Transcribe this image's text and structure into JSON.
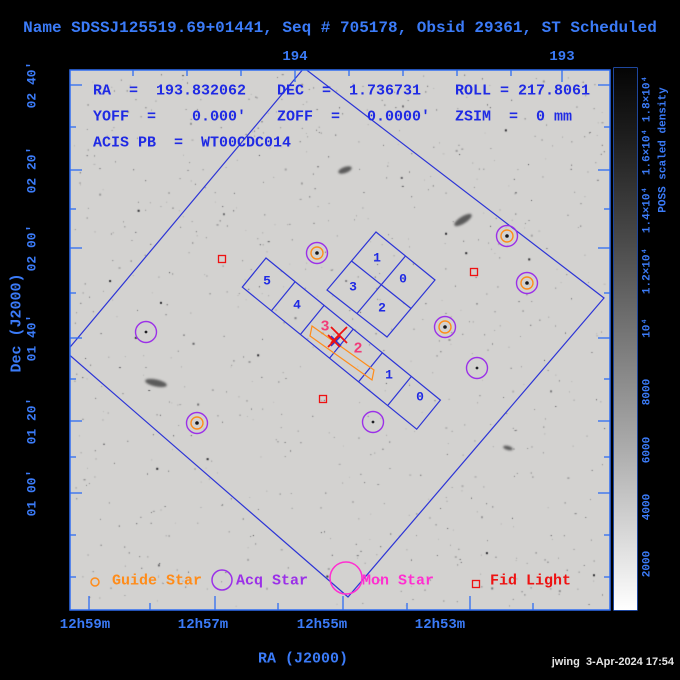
{
  "title": "Name SDSSJ125519.69+01441, Seq # 705178, Obsid 29361, ST Scheduled",
  "overlay": {
    "ra": "RA  =  193.832062",
    "dec": "DEC  =  1.736731",
    "roll": "ROLL = 217.8061",
    "yoff": "YOFF  =    0.000'",
    "zoff": "ZOFF  =   0.0000'",
    "zsim": "ZSIM  =  0 mm",
    "acis_pb": "ACIS PB  =  WT00CDC014"
  },
  "axes": {
    "x_label": "RA (J2000)",
    "y_label": "Dec (J2000)",
    "top_ticks": [
      {
        "label": "194",
        "x": 295
      },
      {
        "label": "193",
        "x": 562
      }
    ],
    "top_minor": [
      133,
      187,
      241,
      349,
      403,
      457,
      511
    ],
    "bottom_ticks": [
      {
        "label": "12h59m",
        "tick_x": 89,
        "label_x": 85
      },
      {
        "label": "12h57m",
        "tick_x": 215,
        "label_x": 203
      },
      {
        "label": "12h55m",
        "tick_x": 343,
        "label_x": 322
      },
      {
        "label": "12h53m",
        "tick_x": 470,
        "label_x": 440
      }
    ],
    "bottom_minor": [
      150,
      278,
      407,
      533
    ],
    "left_ticks": [
      {
        "label": "02 40'",
        "y": 85
      },
      {
        "label": "02 20'",
        "y": 170
      },
      {
        "label": "02 00'",
        "y": 248
      },
      {
        "label": "01 40'",
        "y": 338
      },
      {
        "label": "01 20'",
        "y": 421
      },
      {
        "label": "01 00'",
        "y": 493
      }
    ],
    "left_minor": [
      127,
      209,
      293,
      379,
      457,
      535,
      577
    ]
  },
  "colorbar": {
    "title": "POSS scaled density",
    "ticks": [
      {
        "label": "1.8×10⁴",
        "y": 99
      },
      {
        "label": "1.6×10⁴",
        "y": 152
      },
      {
        "label": "1.4×10⁴",
        "y": 210
      },
      {
        "label": "1.2×10⁴",
        "y": 271
      },
      {
        "label": "10⁴",
        "y": 328
      },
      {
        "label": "8000",
        "y": 392
      },
      {
        "label": "6000",
        "y": 450
      },
      {
        "label": "4000",
        "y": 507
      },
      {
        "label": "2000",
        "y": 564
      }
    ],
    "minor": [
      125,
      181,
      240,
      299,
      360,
      421,
      478,
      535,
      590
    ]
  },
  "fov": {
    "outline": [
      [
        304,
        68
      ],
      [
        604,
        298
      ],
      [
        348,
        597
      ],
      [
        66,
        352
      ]
    ],
    "acis_i": {
      "outline": [
        [
          376,
          232
        ],
        [
          435,
          280
        ],
        [
          387,
          337
        ],
        [
          327,
          290
        ]
      ],
      "dividers": [
        [
          [
            405.5,
            256
          ],
          [
            357,
            313.5
          ]
        ],
        [
          [
            351.5,
            261
          ],
          [
            411,
            308.5
          ]
        ]
      ]
    },
    "acis_s": {
      "outline": [
        [
          266,
          258
        ],
        [
          440.4,
          400.1
        ],
        [
          416.7,
          429.2
        ],
        [
          242.3,
          287.1
        ]
      ],
      "dividers": [
        [
          [
            295.1,
            281.7
          ],
          [
            271.4,
            310.8
          ]
        ],
        [
          [
            324.1,
            305.4
          ],
          [
            300.4,
            334.5
          ]
        ],
        [
          [
            353.2,
            329.1
          ],
          [
            329.5,
            358.2
          ]
        ],
        [
          [
            382.3,
            352.8
          ],
          [
            358.6,
            381.8
          ]
        ],
        [
          [
            411.4,
            376.4
          ],
          [
            387.7,
            405.5
          ]
        ]
      ]
    },
    "subarray": [
      [
        312,
        326
      ],
      [
        374,
        370
      ],
      [
        372,
        380
      ],
      [
        310,
        336
      ]
    ]
  },
  "chips": {
    "acis_i_labels": [
      {
        "label": "1",
        "x": 377,
        "y": 258
      },
      {
        "label": "0",
        "x": 403,
        "y": 279
      },
      {
        "label": "3",
        "x": 353,
        "y": 287
      },
      {
        "label": "2",
        "x": 382,
        "y": 308
      }
    ],
    "acis_s_labels": [
      {
        "label": "5",
        "x": 267,
        "y": 281
      },
      {
        "label": "4",
        "x": 297,
        "y": 305
      },
      {
        "label": "1",
        "x": 389,
        "y": 375
      },
      {
        "label": "0",
        "x": 420,
        "y": 397
      }
    ],
    "highlight_labels": [
      {
        "label": "3",
        "x": 325,
        "y": 327
      },
      {
        "label": "2",
        "x": 358,
        "y": 349
      }
    ]
  },
  "markers": {
    "target_x": [
      {
        "x": 339,
        "y": 335,
        "r": 8
      },
      {
        "x": 334,
        "y": 341,
        "r": 6
      }
    ],
    "aimpoint_cross": {
      "x": 336,
      "y": 341,
      "r": 5
    },
    "guide_acq_stars": [
      {
        "x": 317,
        "y": 253
      },
      {
        "x": 507,
        "y": 236
      },
      {
        "x": 527,
        "y": 283
      },
      {
        "x": 445,
        "y": 327
      },
      {
        "x": 197,
        "y": 423
      }
    ],
    "acq_stars": [
      {
        "x": 146,
        "y": 332
      },
      {
        "x": 477,
        "y": 368
      },
      {
        "x": 373,
        "y": 422
      }
    ],
    "fid_lights": [
      {
        "x": 222,
        "y": 259
      },
      {
        "x": 474,
        "y": 272
      },
      {
        "x": 323,
        "y": 399
      }
    ],
    "galaxies": [
      {
        "x": 156,
        "y": 383,
        "rx": 11,
        "ry": 3.5,
        "rot": 12
      },
      {
        "x": 463,
        "y": 220,
        "rx": 10,
        "ry": 3.5,
        "rot": -32
      },
      {
        "x": 345,
        "y": 170,
        "rx": 7,
        "ry": 3,
        "rot": -20
      },
      {
        "x": 508,
        "y": 448,
        "rx": 5,
        "ry": 2,
        "rot": 15
      }
    ]
  },
  "legend": {
    "items": [
      {
        "label": "Guide Star",
        "glyph": "circle",
        "r": 4,
        "gx": 95,
        "gy": 582,
        "tx": 112,
        "color_key": "orange"
      },
      {
        "label": "Acq Star",
        "glyph": "circle",
        "r": 10,
        "gx": 222,
        "gy": 580,
        "tx": 236,
        "color_key": "purple"
      },
      {
        "label": "Mon Star",
        "glyph": "circle",
        "r": 16,
        "gx": 346,
        "gy": 578,
        "tx": 362,
        "color_key": "magenta"
      },
      {
        "label": "Fid Light",
        "glyph": "square",
        "r": 3.5,
        "gx": 476,
        "gy": 584,
        "tx": 490,
        "color_key": "red"
      }
    ],
    "text_y": 581
  },
  "footer": {
    "timestamp": "jwing  3-Apr-2024 17:54"
  },
  "colors": {
    "background": "#000000",
    "image_gray": "#d3d2d0",
    "axis_blue": "#3b7bf8",
    "frame_blue": "#2f6df2",
    "annotation_blue": "#1f2ae4",
    "fov_blue": "#2c34d6",
    "orange": "#ff8c1a",
    "purple": "#9b30e8",
    "magenta": "#ff2fd0",
    "red": "#ee1111",
    "pink": "#f23b78",
    "timestamp_gray": "#e6e6e6"
  }
}
